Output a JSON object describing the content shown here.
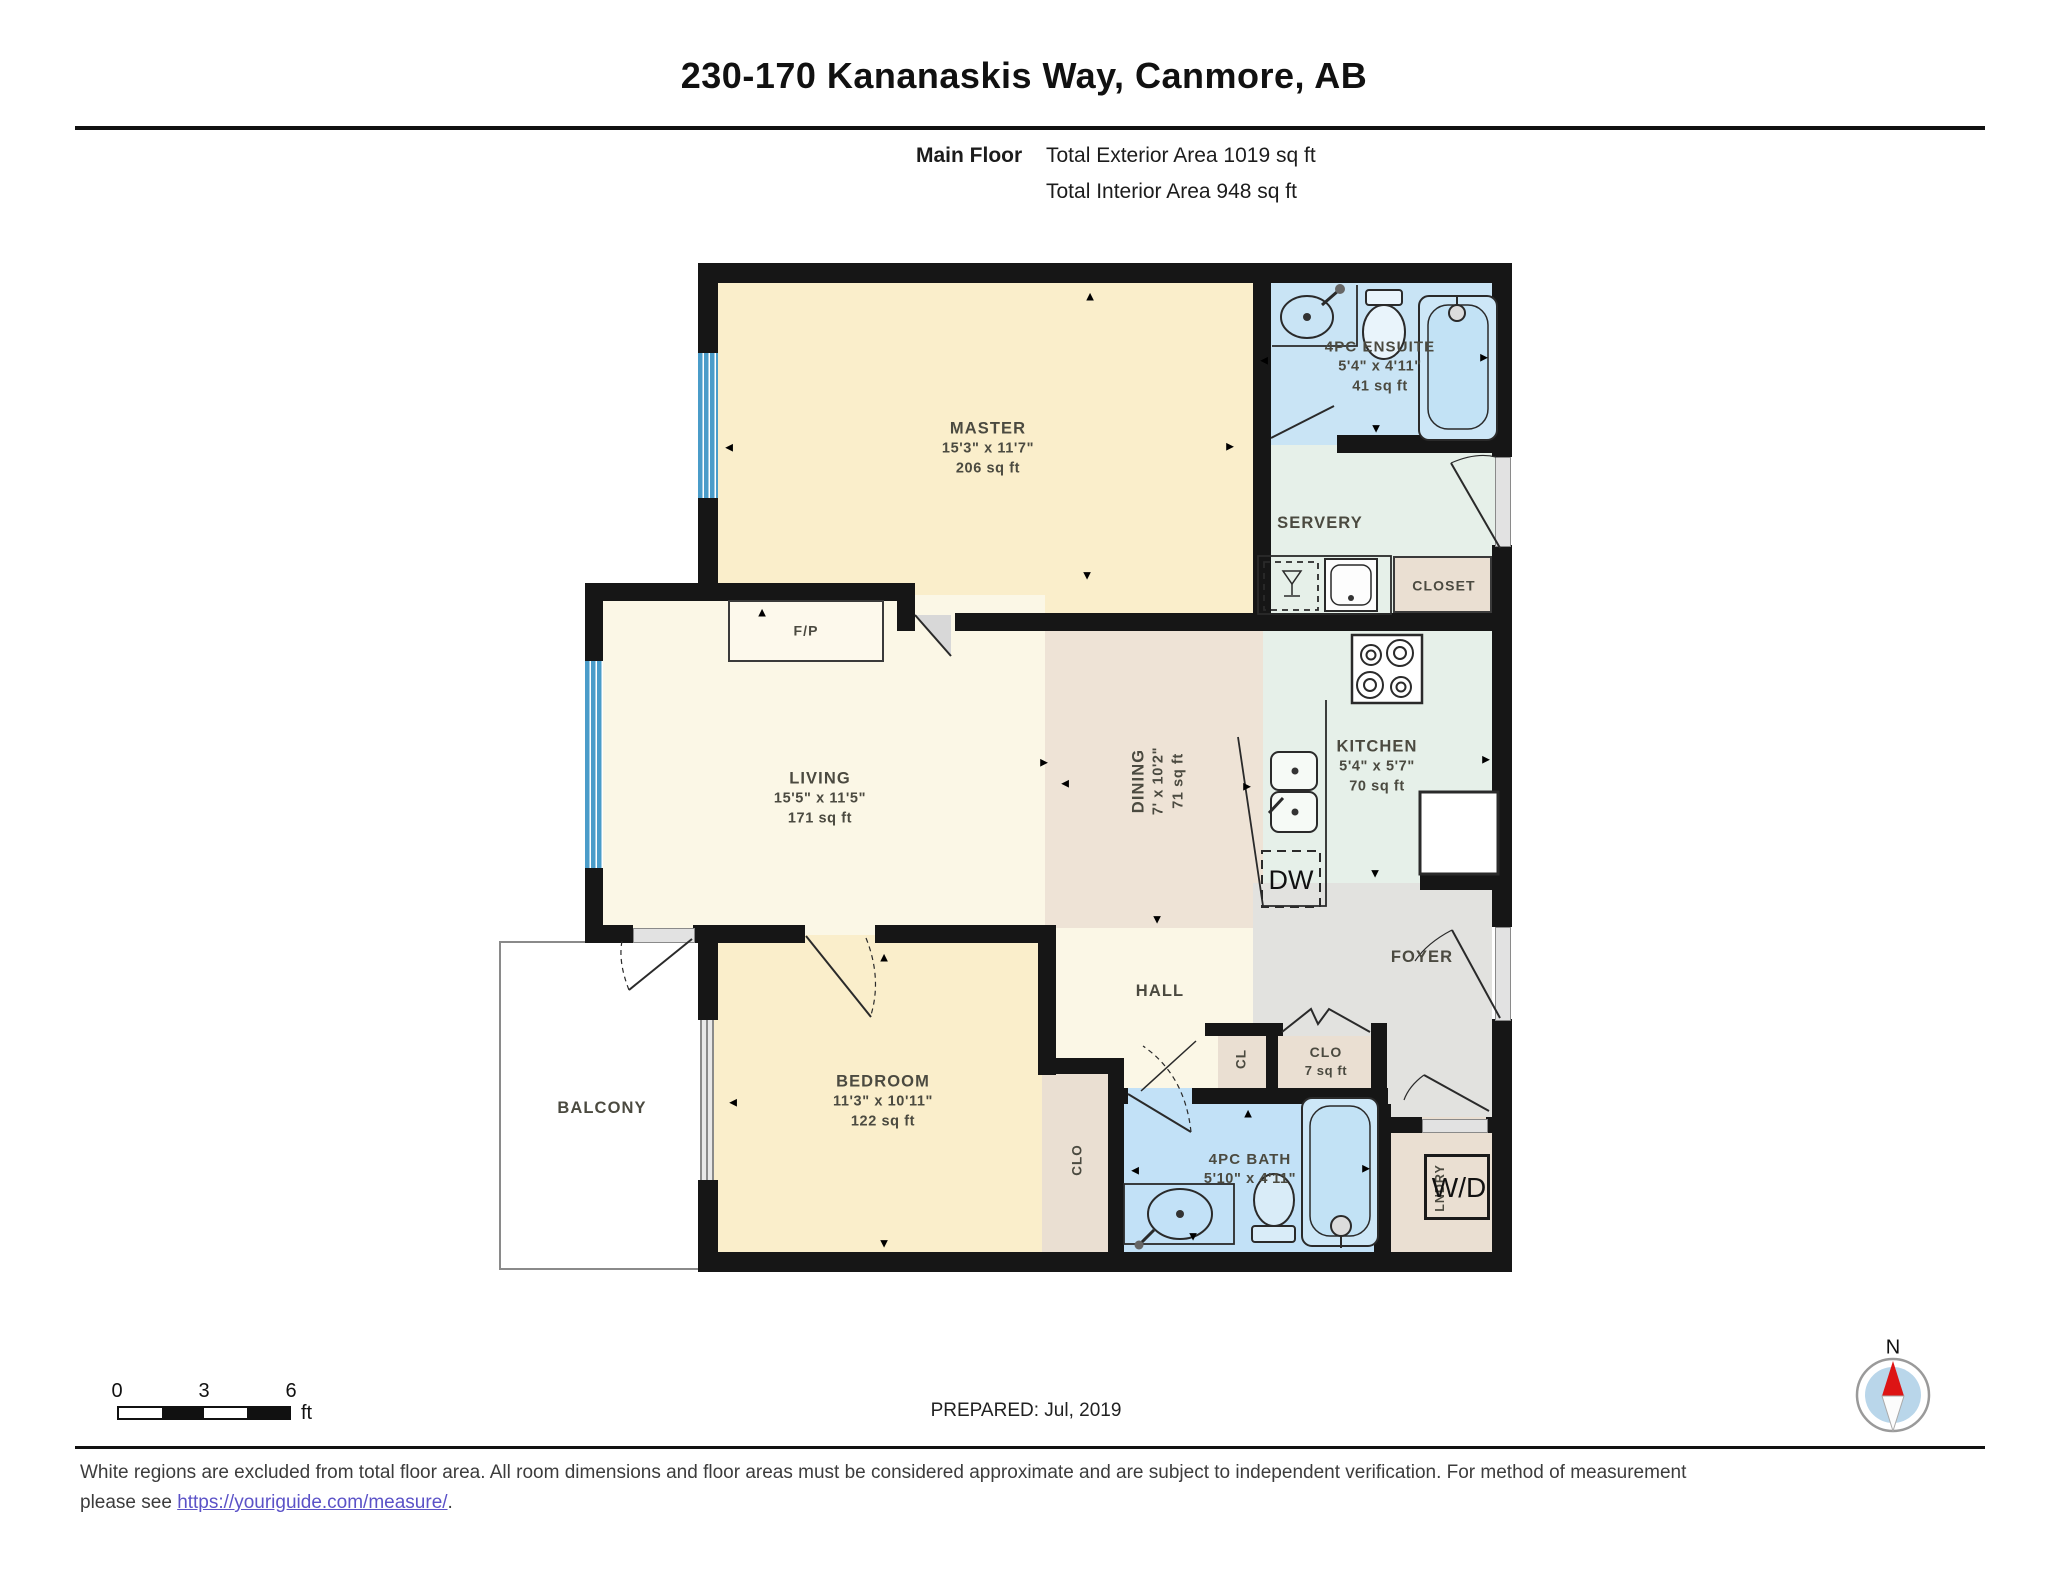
{
  "header": {
    "title": "230-170 Kananaskis Way, Canmore, AB",
    "floor_label": "Main Floor",
    "exterior_area": "Total Exterior Area 1019 sq ft",
    "interior_area": "Total Interior Area 948 sq ft"
  },
  "rooms": {
    "master": {
      "name": "MASTER",
      "dim": "15'3\" x 11'7\"",
      "area": "206 sq ft"
    },
    "ensuite": {
      "name": "4PC ENSUITE",
      "dim": "5'4\" x 4'11\"",
      "area": "41 sq ft"
    },
    "servery": {
      "name": "SERVERY"
    },
    "closet_top": {
      "name": "CLOSET"
    },
    "living": {
      "name": "LIVING",
      "dim": "15'5\" x 11'5\"",
      "area": "171 sq ft"
    },
    "dining": {
      "name": "DINING",
      "dim": "7' x 10'2\"",
      "area": "71 sq ft"
    },
    "kitchen": {
      "name": "KITCHEN",
      "dim": "5'4\" x 5'7\"",
      "area": "70 sq ft"
    },
    "fireplace": {
      "name": "F/P"
    },
    "hall": {
      "name": "HALL"
    },
    "foyer": {
      "name": "FOYER"
    },
    "bedroom": {
      "name": "BEDROOM",
      "dim": "11'3\" x 10'11\"",
      "area": "122 sq ft"
    },
    "balcony": {
      "name": "BALCONY"
    },
    "bath": {
      "name": "4PC BATH",
      "dim": "5'10\" x 4'11\""
    },
    "closet_hall": {
      "name": "CLO",
      "area": "7 sq ft"
    },
    "closet_small": {
      "name": "CL"
    },
    "closet_bedroom": {
      "name": "CLO"
    },
    "laundry": {
      "name": "LNDRY"
    },
    "washer_dryer": {
      "name": "W/D"
    },
    "dishwasher": {
      "name": "DW"
    }
  },
  "scale_bar": {
    "tick0": "0",
    "tick3": "3",
    "tick6": "6",
    "unit": "ft"
  },
  "prepared": "PREPARED: Jul, 2019",
  "compass": {
    "north_label": "N"
  },
  "footer": {
    "line1": "White regions are excluded from total floor area. All room dimensions and floor areas must be considered approximate and are subject to independent verification. For method of measurement",
    "line2_prefix": "please see ",
    "link_text": "https://youriguide.com/measure/",
    "line2_suffix": "."
  },
  "icons": {
    "arrow_up": "▲",
    "arrow_down": "▼",
    "arrow_left": "◄",
    "arrow_right": "►"
  },
  "colors": {
    "wall": "#161616",
    "window": "#4a9cc9",
    "bath_fill": "#c2e1f7",
    "ensuite_fill": "#c9e4f5",
    "bedroom_fill": "#faeecb",
    "living_fill": "#fbf7e6",
    "dining_fill": "#eee3d6",
    "kitchen_fill": "#e6f0e9",
    "foyer_fill": "#e2e2df",
    "closet_fill": "#eadfd2"
  }
}
